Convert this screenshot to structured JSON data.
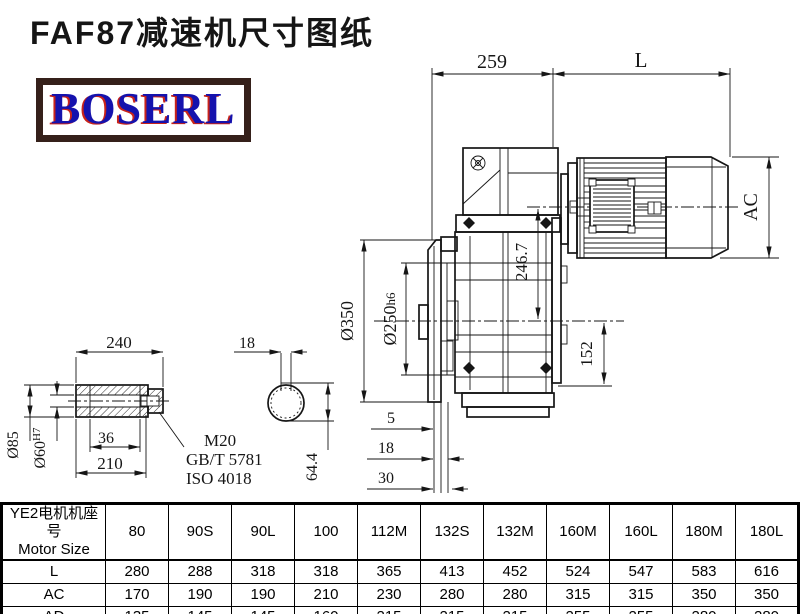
{
  "title": "FAF87减速机尺寸图纸",
  "logo": {
    "text": "BOSERL"
  },
  "drawing": {
    "main_view": {
      "dim_gearbox_length": "259",
      "dim_motor_length": "L",
      "dim_motor_diameter": "AC",
      "dim_shaft_offset": "246.7",
      "dim_axis_to_base": "152",
      "dim_flange_od": "Ø350",
      "dim_pilot_d": "Ø250",
      "dim_pilot_tol": "h6",
      "dim_step_a": "5",
      "dim_step_b": "18",
      "dim_step_c": "30"
    },
    "shaft_view": {
      "dim_length": "240",
      "dim_od": "Ø85",
      "dim_bore": "Ø60",
      "dim_bore_tol": "H7",
      "dim_counterbore": "36",
      "dim_usable_length": "210",
      "leader_line1": "M20",
      "leader_line2": "GB/T 5781",
      "leader_line3": "ISO 4018"
    },
    "section_view": {
      "dim_key_width": "18",
      "dim_key_depth": "64.4"
    }
  },
  "table": {
    "header_col1_line1": "YE2电机机座号",
    "header_col1_line2": "Motor Size",
    "columns": [
      "80",
      "90S",
      "90L",
      "100",
      "112M",
      "132S",
      "132M",
      "160M",
      "160L",
      "180M",
      "180L"
    ],
    "rows": [
      {
        "label": "L",
        "values": [
          "280",
          "288",
          "318",
          "318",
          "365",
          "413",
          "452",
          "524",
          "547",
          "583",
          "616"
        ]
      },
      {
        "label": "AC",
        "values": [
          "170",
          "190",
          "190",
          "210",
          "230",
          "280",
          "280",
          "315",
          "315",
          "350",
          "350"
        ]
      },
      {
        "label": "AD",
        "values": [
          "135",
          "145",
          "145",
          "160",
          "215",
          "215",
          "215",
          "255",
          "255",
          "280",
          "280"
        ]
      }
    ]
  },
  "colors": {
    "line": "#161616",
    "logo_text": "#1512ad",
    "logo_shadow": "#c8231a",
    "logo_border": "#35201a"
  }
}
